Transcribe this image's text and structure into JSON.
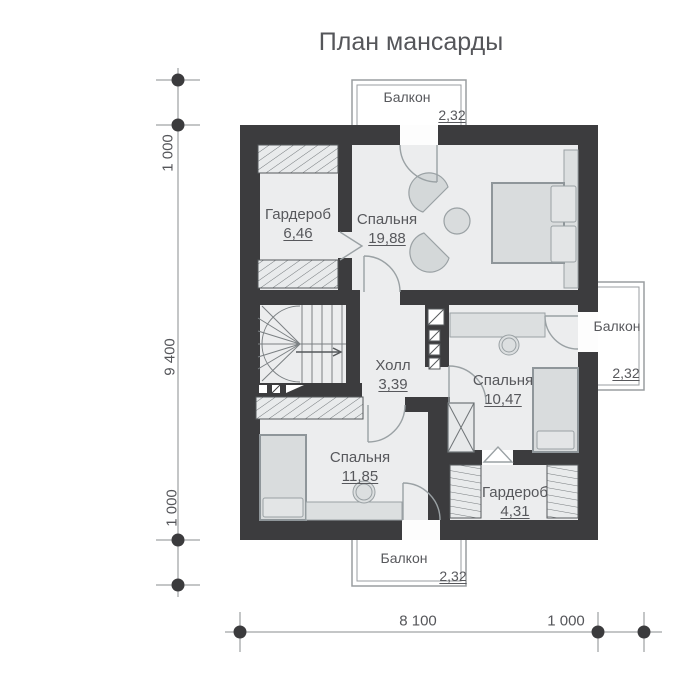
{
  "title": "План мансарды",
  "rooms": {
    "wardrobe_top": {
      "name": "Гардероб",
      "area": "6,46"
    },
    "bedroom_large": {
      "name": "Спальня",
      "area": "19,88"
    },
    "hall": {
      "name": "Холл",
      "area": "3,39"
    },
    "bedroom_right": {
      "name": "Спальня",
      "area": "10,47"
    },
    "bedroom_bottom": {
      "name": "Спальня",
      "area": "11,85"
    },
    "wardrobe_bottom": {
      "name": "Гардероб",
      "area": "4,31"
    }
  },
  "balconies": {
    "top": {
      "name": "Балкон",
      "area": "2,32"
    },
    "right": {
      "name": "Балкон",
      "area": "2,32"
    },
    "bottom": {
      "name": "Балкон",
      "area": "2,32"
    }
  },
  "dimensions": {
    "left": [
      "1 000",
      "9 400",
      "1 000"
    ],
    "bottom": [
      "8 100",
      "1 000"
    ]
  },
  "colors": {
    "wall": "#3c3c3e",
    "floor": "#ecedee",
    "furniture": "#dcdfe0",
    "furniture_stroke": "#8f969a",
    "hatch_fill": "#e9ebec",
    "railing": "#9a9da0",
    "text": "#57585c",
    "dimension_dot": "#3b3b3d"
  }
}
